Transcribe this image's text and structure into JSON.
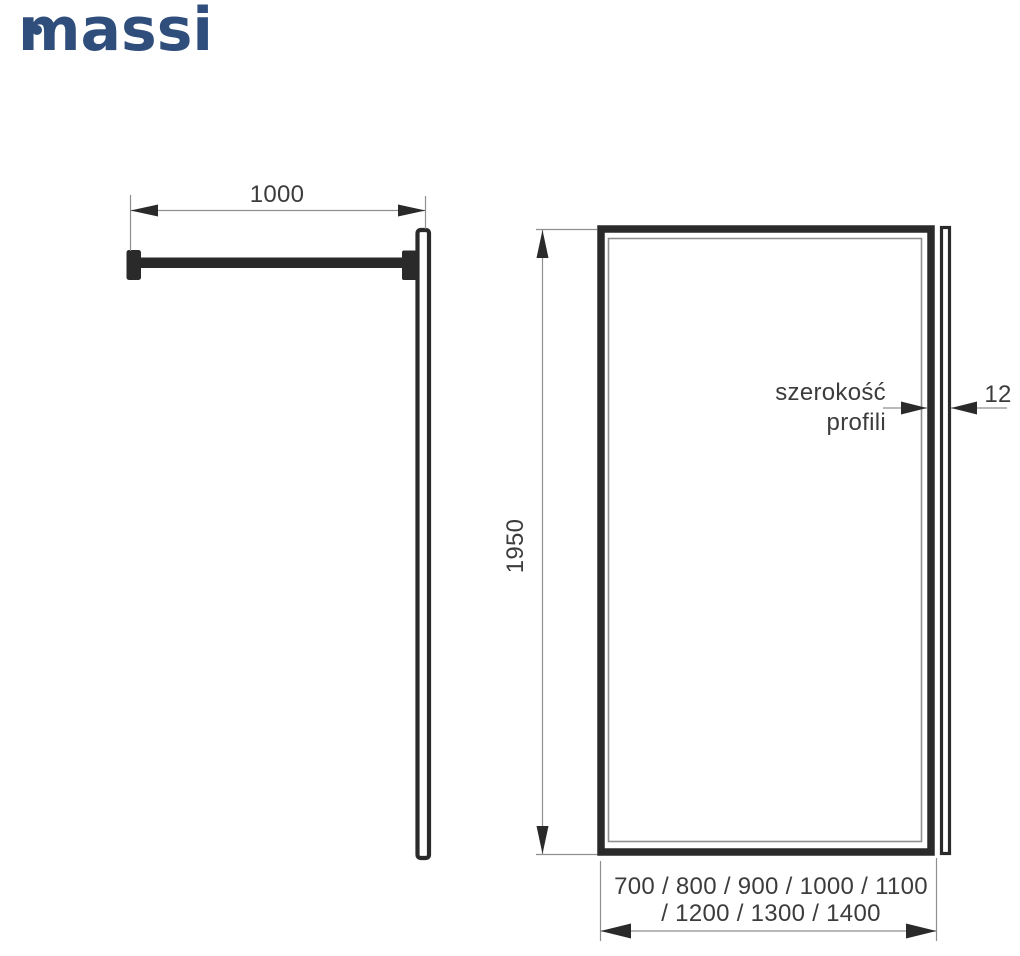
{
  "brand": {
    "name": "massi",
    "color": "#2f4e7c"
  },
  "side_view": {
    "arm_length_mm": "1000"
  },
  "front_view": {
    "height_mm": "1950",
    "profile_caption_line1": "szerokość",
    "profile_caption_line2": "profili",
    "profile_width_mm": "12",
    "available_widths_line1": "700 / 800 / 900 / 1000 / 1100",
    "available_widths_line2": "/ 1200 / 1300 / 1400"
  },
  "colors": {
    "background": "#ffffff",
    "drawing_line": "#2a2a2a",
    "thin_line": "#8f8f8f",
    "text": "#3c3c3c",
    "brand": "#2f4e7c"
  }
}
